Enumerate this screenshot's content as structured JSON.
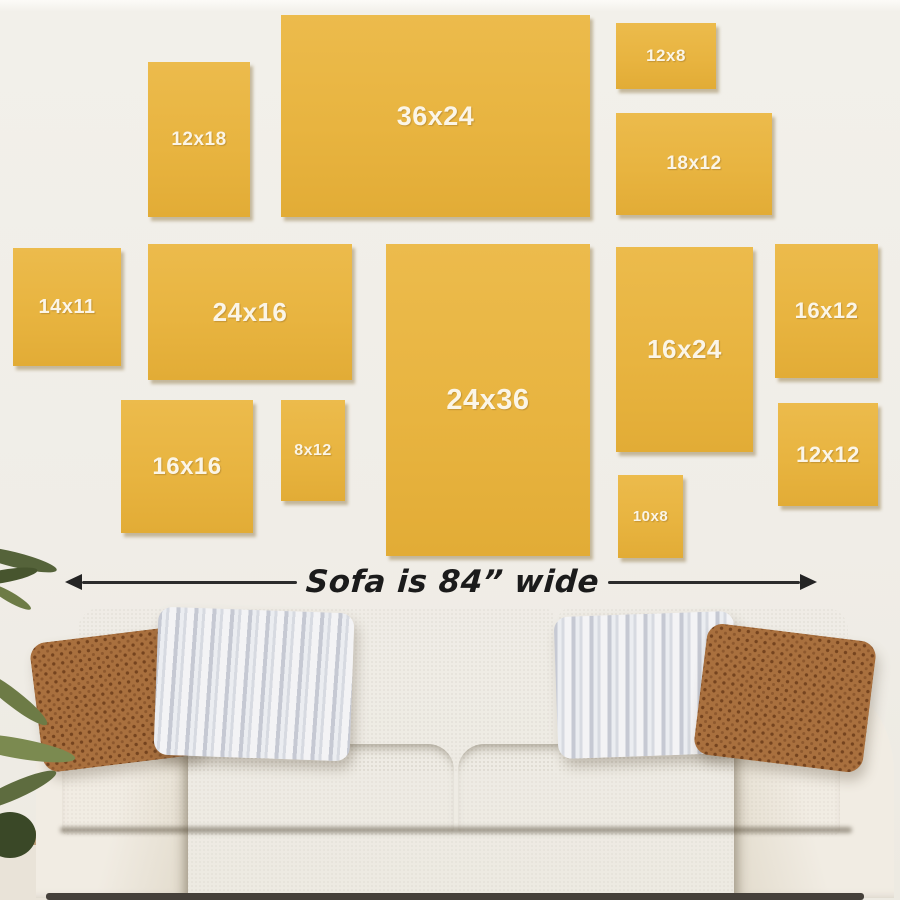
{
  "scene": {
    "wall_color": "#F0EDE7",
    "canvas_color": "#E8B440",
    "canvas_highlight": "#ECBB4C",
    "canvas_lowlight": "#E2AC36",
    "label_color": "#FBF5E7",
    "arrow_color": "#2c2c2c"
  },
  "canvases": [
    {
      "label": "12x18",
      "x": 148,
      "y": 62,
      "w": 102,
      "h": 155,
      "font": 19
    },
    {
      "label": "36x24",
      "x": 281,
      "y": 15,
      "w": 309,
      "h": 202,
      "font": 27
    },
    {
      "label": "12x8",
      "x": 616,
      "y": 23,
      "w": 100,
      "h": 66,
      "font": 17
    },
    {
      "label": "18x12",
      "x": 616,
      "y": 113,
      "w": 156,
      "h": 102,
      "font": 19
    },
    {
      "label": "14x11",
      "x": 13,
      "y": 248,
      "w": 108,
      "h": 118,
      "font": 20
    },
    {
      "label": "24x16",
      "x": 148,
      "y": 244,
      "w": 204,
      "h": 136,
      "font": 26
    },
    {
      "label": "24x36",
      "x": 386,
      "y": 244,
      "w": 204,
      "h": 312,
      "font": 29
    },
    {
      "label": "16x24",
      "x": 616,
      "y": 247,
      "w": 137,
      "h": 205,
      "font": 26
    },
    {
      "label": "16x12",
      "x": 775,
      "y": 244,
      "w": 103,
      "h": 134,
      "font": 22
    },
    {
      "label": "16x16",
      "x": 121,
      "y": 400,
      "w": 132,
      "h": 133,
      "font": 24
    },
    {
      "label": "8x12",
      "x": 281,
      "y": 400,
      "w": 64,
      "h": 101,
      "font": 16
    },
    {
      "label": "10x8",
      "x": 618,
      "y": 475,
      "w": 65,
      "h": 83,
      "font": 15
    },
    {
      "label": "12x12",
      "x": 778,
      "y": 403,
      "w": 100,
      "h": 103,
      "font": 22
    }
  ],
  "sofa": {
    "caption": "Sofa is 84” wide"
  }
}
